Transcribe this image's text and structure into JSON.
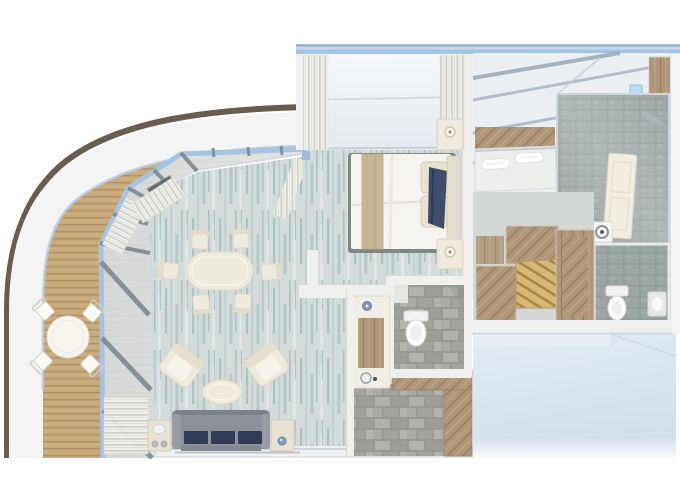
{
  "scene": {
    "type": "3D rendered cruise-ship suite floor plan, top-down view",
    "areas": [
      "wrap-around balcony with teak deck and outdoor dining set",
      "open-plan living and dining room",
      "bedroom with glazed exterior wall and curtains",
      "bathroom with glass ceiling, double vanity and shower",
      "walk-in wardrobe",
      "guest wc with writing desk",
      "entrance hall"
    ]
  },
  "colors": {
    "hull_trim": "#6a5d50",
    "hull_band": "#f4f4f5",
    "deck_base": "#c9a87a",
    "deck_line": "#a8895c",
    "frame_blue": "#a5c3e2",
    "glass_tint": "#dfe9f1",
    "mullion": "#7b848c",
    "carpet_base": "#d4dcdb",
    "carpet_streak": "#7ea7a9",
    "wall_white": "#f0f1ef",
    "cream": "#efeade",
    "sofa_grey": "#8d929a",
    "cushion_navy": "#2f3b57",
    "bed_white": "#f5f4f0",
    "bed_stripe": "#c6b795",
    "throw_navy": "#3d4d6b",
    "wood": "#b1977a",
    "wood_dark": "#8e775b",
    "stone": "#a7a8a2",
    "tile": "#9aa5a4",
    "pale_wall": "#d9e4ee",
    "ceiling_glass": "#eceff2",
    "ceil_mullion": "#a3b2bf",
    "curtain": "#f1f1ee"
  }
}
